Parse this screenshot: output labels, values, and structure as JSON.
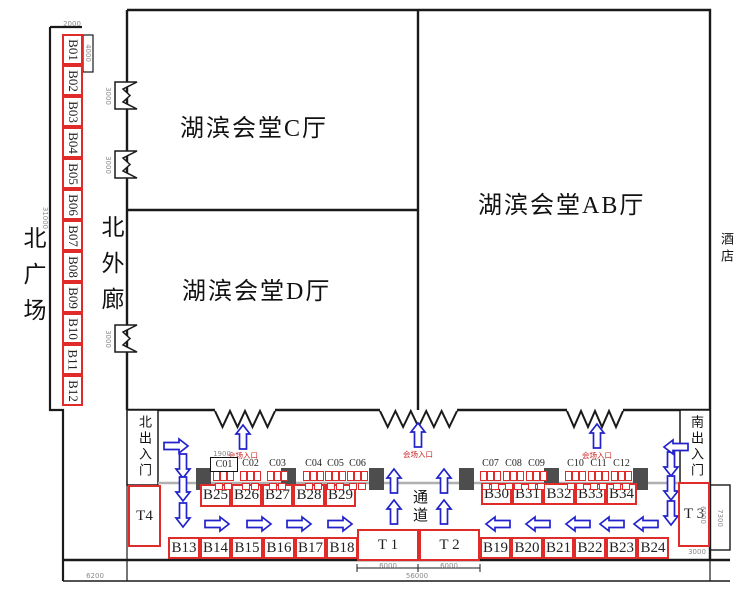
{
  "plaza": {
    "label": "北广场"
  },
  "north_corridor": {
    "label": "北外廊"
  },
  "halls": {
    "c": "湖滨会堂C厅",
    "d": "湖滨会堂D厅",
    "ab": "湖滨会堂AB厅"
  },
  "hotel": {
    "label": "酒店"
  },
  "gates": {
    "north": "北出入门",
    "south": "南出入门"
  },
  "passage": {
    "label": "通道"
  },
  "entrances": {
    "label": "会场入口"
  },
  "booths": {
    "left_column": [
      "B01",
      "B02",
      "B03",
      "B04",
      "B05",
      "B06",
      "B07",
      "B08",
      "B09",
      "B10",
      "B11",
      "B12"
    ],
    "inner_left": [
      "B25",
      "B26",
      "B27",
      "B28",
      "B29"
    ],
    "inner_right": [
      "B30",
      "B31",
      "B32",
      "B33",
      "B34"
    ],
    "outer_left": [
      "B13",
      "B14",
      "B15",
      "B16",
      "B17",
      "B18"
    ],
    "outer_right": [
      "B19",
      "B20",
      "B21",
      "B22",
      "B23",
      "B24"
    ],
    "t1": "T 1",
    "t2": "T 2",
    "t3": "T 3",
    "t4": "T4"
  },
  "tables": {
    "left": [
      "C01",
      "C02",
      "C03",
      "C04",
      "C05",
      "C06"
    ],
    "right": [
      "C07",
      "C08",
      "C09",
      "C10",
      "C11",
      "C12"
    ]
  },
  "dimensions": {
    "top_width": "2000",
    "top_depth": "4000",
    "plaza_height": "31000",
    "door": "3000",
    "c01_width": "1900",
    "t1_width": "6000",
    "t2_width": "6000",
    "corridor_width": "56000",
    "left_width": "6200",
    "t3_height": "6000",
    "south_depth": "7300",
    "t3_width": "3000"
  },
  "colors": {
    "booth_red": "#e02b2b",
    "arrow_blue": "#2222cc",
    "pillar_gray": "#4d4d4d",
    "wall_black": "#1a1a1a",
    "dim_gray": "#8a8a8a",
    "entrance_red": "#cc2222"
  }
}
